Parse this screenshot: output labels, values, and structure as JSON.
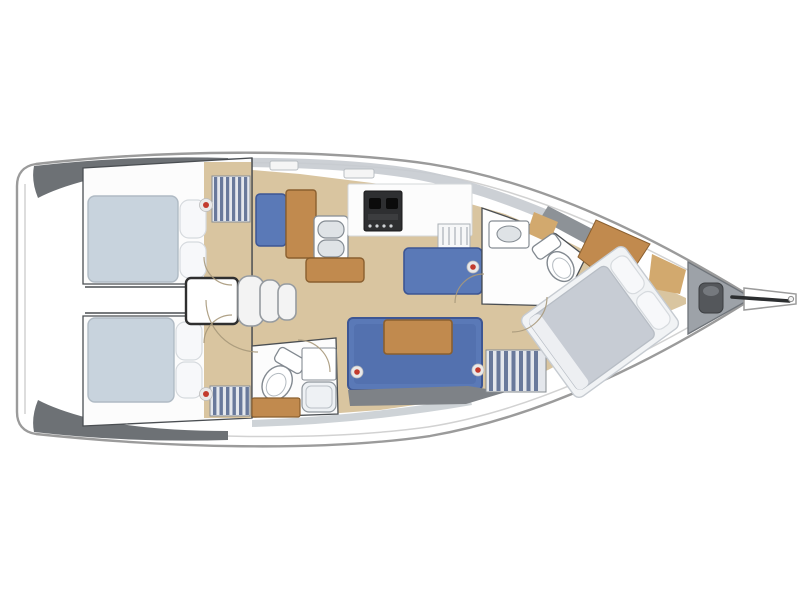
{
  "diagram": {
    "type": "sailing-yacht-interior-floor-plan",
    "orientation": {
      "bow": "right",
      "stern": "left"
    },
    "features": [
      "hull",
      "transom-platform",
      "side-deck-port",
      "side-deck-starboard",
      "coachroof-trim",
      "deck-hatches",
      "aft-cabin-port",
      "aft-cabin-starboard",
      "aft-cabin-double-berths",
      "corridor",
      "companionway-steps",
      "galley-double-sink",
      "galley-stove",
      "galley-counter",
      "dish-rack",
      "chart-seat",
      "chart-table",
      "nav-seat",
      "salon-settee",
      "salon-table",
      "aft-head-toilet",
      "aft-head-sink",
      "aft-head-cabinet",
      "forward-head-toilet",
      "forward-head-sink",
      "forward-cabin-double-berth",
      "forward-cabin-desk",
      "hanging-lockers",
      "hatch-markers",
      "anchor-locker",
      "windlass",
      "bowsprit"
    ]
  },
  "palette": {
    "hull_fill": "#ffffff",
    "hull_stroke": "#9b9b9b",
    "hull_inner_stroke": "#d2d2d2",
    "deck_dark": "#6d7175",
    "deck_mid": "#8d9297",
    "coachroof": "#c6cbd0",
    "floor_tan": "#d9c5a0",
    "wood": "#c18a4e",
    "wood_light": "#d2a96e",
    "wood_dark": "#8a5f2f",
    "settee_blue": "#5a79b7",
    "settee_blue_dark": "#3d5694",
    "mattress_blue_grey": "#c8d3dd",
    "mattress_grey": "#c7ccd4",
    "pillow_white": "#f7f8fa",
    "stripe_dark": "#69799b",
    "stripe_light": "#e4e7ec",
    "stove_dark": "#2e2f31",
    "steel": "#dfe3e6",
    "fixture_white": "#fdfdfd",
    "room_white": "#fcfcfc",
    "wall_grey": "#4a4e52",
    "shadow_grey": "#7e8287",
    "marker_red": "#c23b2e",
    "marker_ring": "#e9e9e9",
    "anchor_grey": "#9da2a8",
    "windlass_grey": "#54575b",
    "arc_line": "#a8997b"
  }
}
